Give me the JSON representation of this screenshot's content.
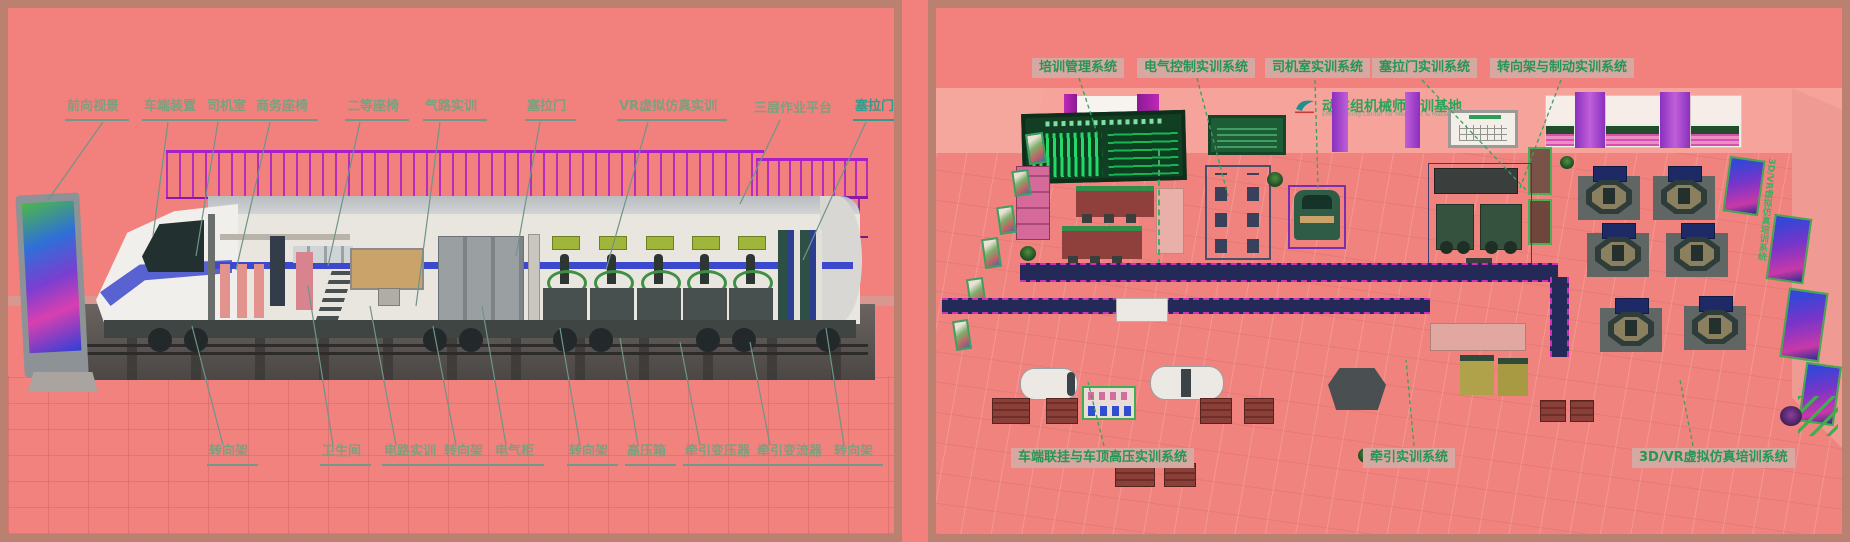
{
  "colors": {
    "background": "#f2817d",
    "frame": "#ba8170",
    "label_green": "#7d9f7e",
    "label_teal": "#2f9c8c",
    "tag_text_green": "#259653",
    "tag_box_bg": "#d7a8a1",
    "scaffold_purple": "#a81fc9",
    "carpet_navy": "#232a58",
    "led_wall_green": "#25d968",
    "train_stripe_blue": "#3d49cc"
  },
  "left_panel": {
    "top_labels": [
      "前向视景",
      "车端装置",
      "司机室",
      "商务座椅",
      "二等座椅",
      "气路实训",
      "塞拉门",
      "VR虚拟仿真实训",
      "三层作业平台",
      "塞拉门"
    ],
    "bottom_labels": [
      "转向架",
      "卫生间",
      "电路实训",
      "转向架",
      "电气柜",
      "转向架",
      "高压箱",
      "牵引变压器",
      "牵引变流器",
      "转向架"
    ]
  },
  "right_panel": {
    "top_labels": [
      "培训管理系统",
      "电气控制实训系统",
      "司机室实训系统",
      "塞拉门实训系统",
      "转向架与制动实训系统"
    ],
    "bottom_labels": [
      "车端联挂与车顶高压实训系统",
      "牵引实训系统",
      "3D/VR虚拟仿真培训系统"
    ],
    "wall_sign": {
      "logo_icon": "swoosh-logo",
      "title": "动车组机械师实训基地",
      "subtitle": "EMU Training Center for Mechanic & Material Operator"
    },
    "right_wall_text": "3D/VR虚拟仿真培训系统"
  }
}
